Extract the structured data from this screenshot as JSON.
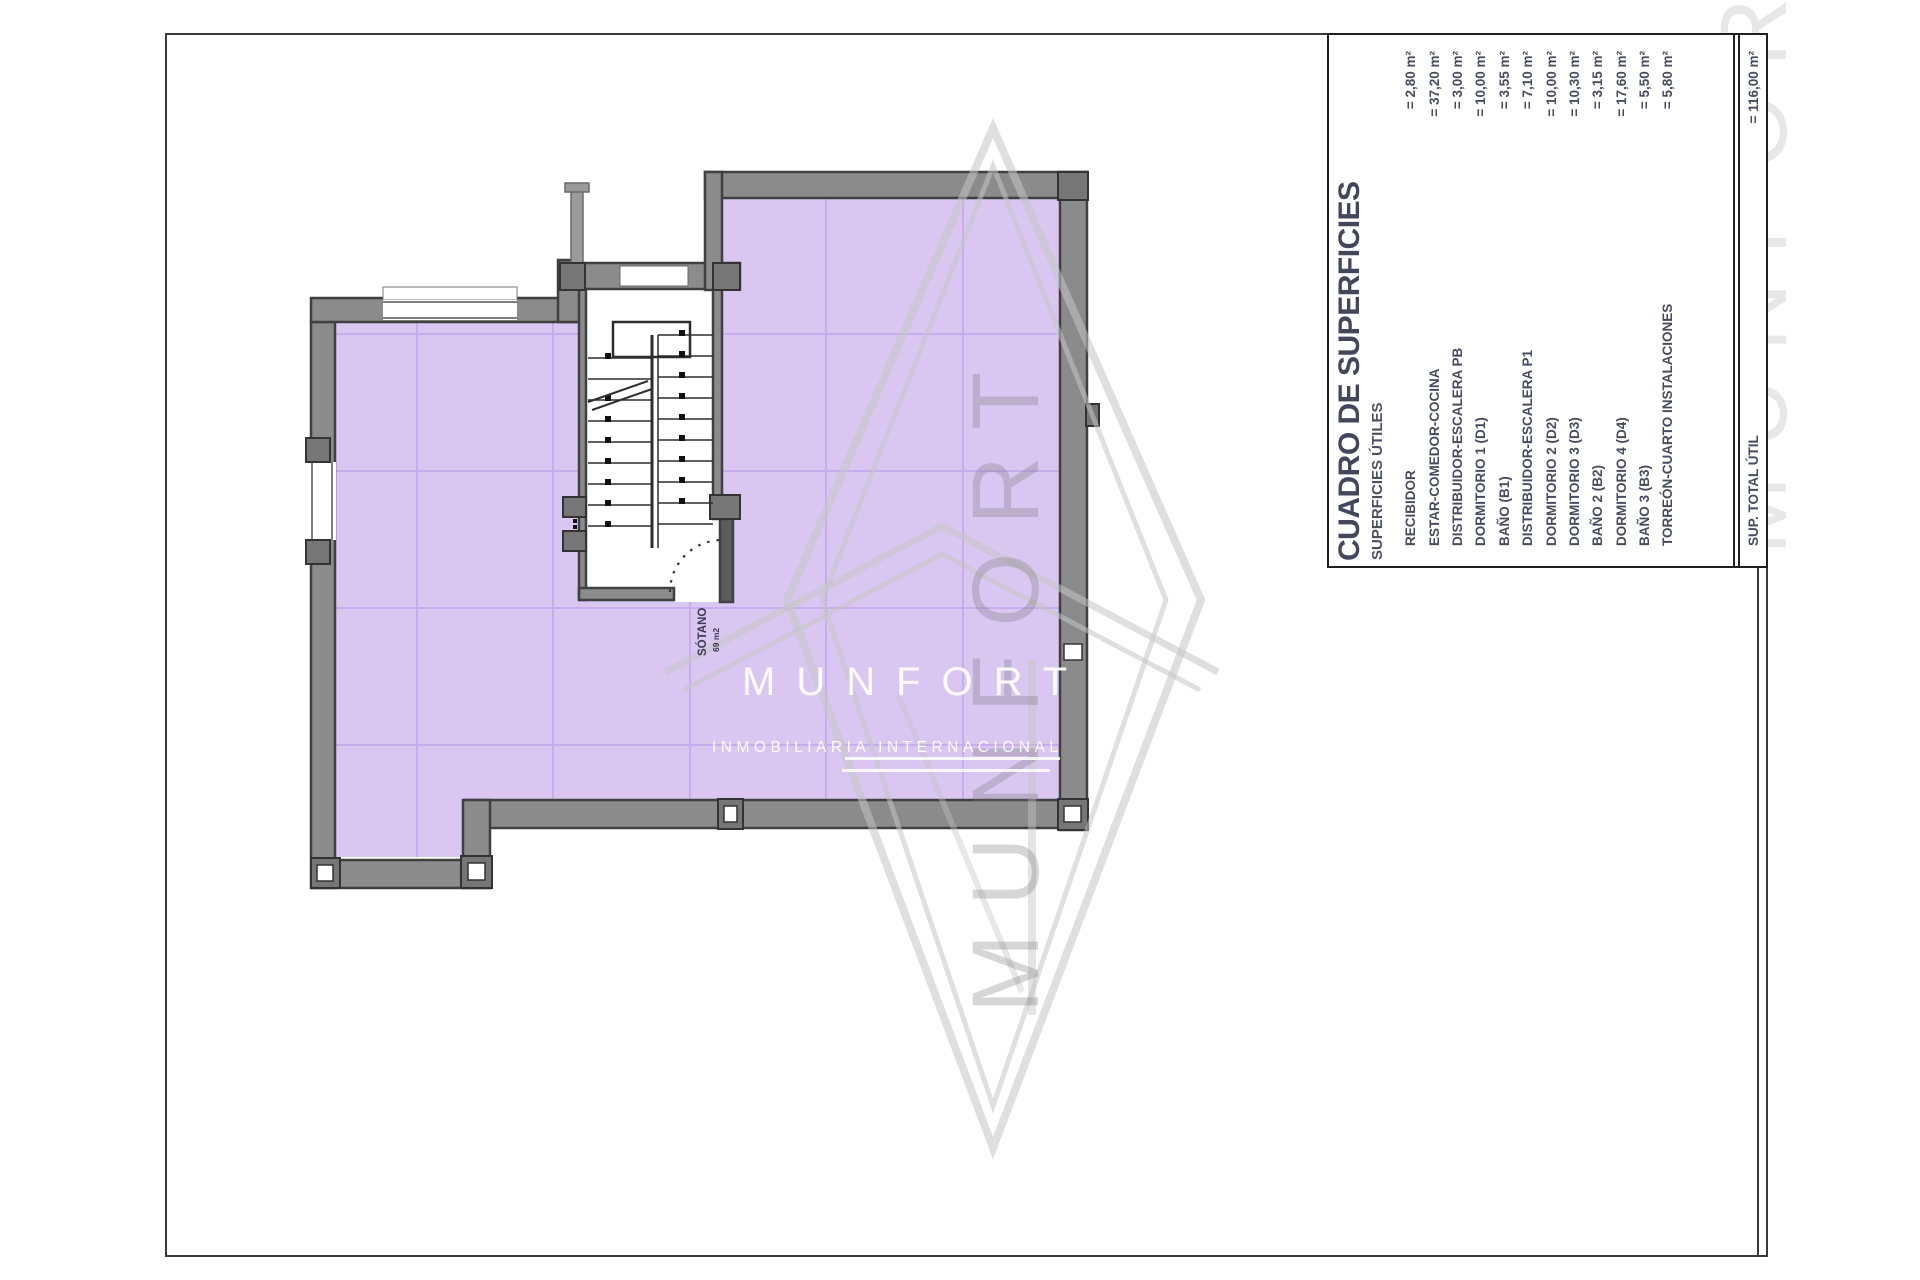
{
  "table": {
    "title": "CUADRO DE SUPERFICIES",
    "subtitle": "SUPERFICIES ÚTILES",
    "rows": [
      {
        "label": "RECIBIDOR",
        "value": "= 2,80 m²"
      },
      {
        "label": "ESTAR-COMEDOR-COCINA",
        "value": "= 37,20 m²"
      },
      {
        "label": "DISTRIBUIDOR-ESCALERA PB",
        "value": "= 3,00 m²"
      },
      {
        "label": "DORMITORIO 1 (D1)",
        "value": "= 10,00 m²"
      },
      {
        "label": "BAÑO (B1)",
        "value": "= 3,55 m²"
      },
      {
        "label": "DISTRIBUIDOR-ESCALERA P1",
        "value": "= 7,10 m²"
      },
      {
        "label": "DORMITORIO 2 (D2)",
        "value": "= 10,00 m²"
      },
      {
        "label": "DORMITORIO 3 (D3)",
        "value": "= 10,30 m²"
      },
      {
        "label": "BAÑO 2 (B2)",
        "value": "= 3,15 m²"
      },
      {
        "label": "DORMITORIO 4 (D4)",
        "value": "= 17,60 m²"
      },
      {
        "label": "BAÑO 3 (B3)",
        "value": "= 5,50 m²"
      },
      {
        "label": "TORREÓN-CUARTO INSTALACIONES",
        "value": "= 5,80 m²"
      }
    ],
    "total": {
      "label": "SUP. TOTAL ÚTIL",
      "value": "= 116,00 m²"
    }
  },
  "plan": {
    "room_label": "SÓTANO",
    "room_area": "69 m2"
  },
  "watermark": {
    "brand": "MUNFORT",
    "tagline": "INMOBILIARIA INTERNACIONAL",
    "giant_text": "MUNFORT"
  },
  "colors": {
    "floor_fill": "#d9c7f2",
    "floor_grid": "#c8adee",
    "wall_fill": "#8b8b8b",
    "wall_edge": "#404040",
    "table_text": "#464b60",
    "label_text": "#3b3b52",
    "watermark_line": "#c4c4c4"
  }
}
